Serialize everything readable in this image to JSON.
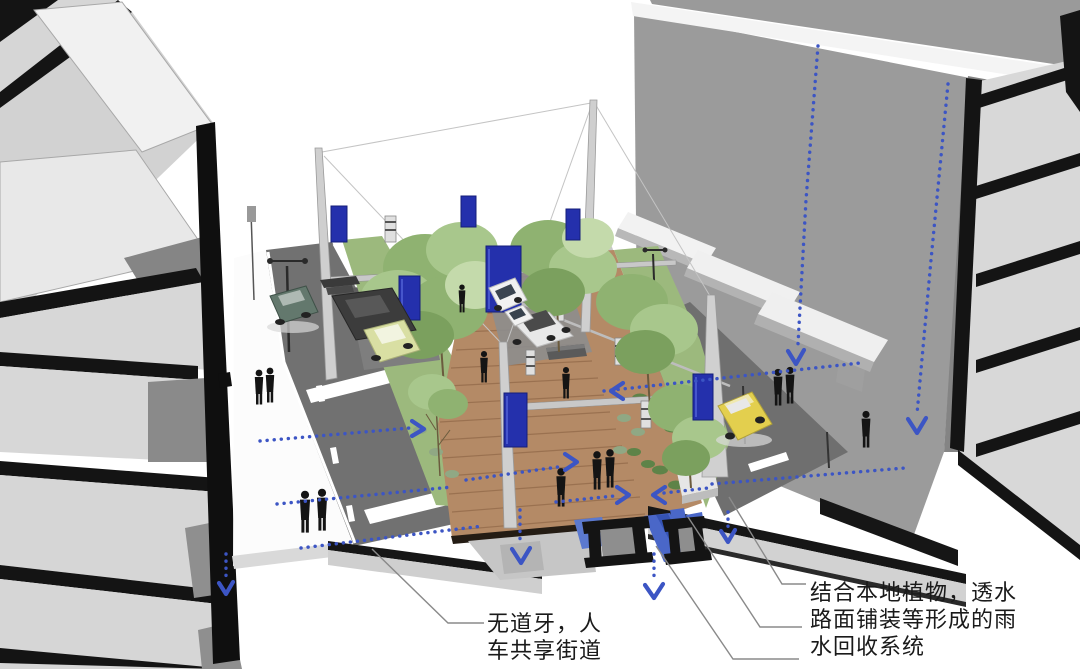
{
  "scene": {
    "type": "axonometric-sectional-street-diagram",
    "background": "#ffffff"
  },
  "annotations": {
    "shared_street": {
      "line1": "无道牙，人",
      "line2": "车共享街道"
    },
    "rainwater_system": {
      "line1": "结合本地植物，透水",
      "line2": "路面铺装等形成的雨",
      "line3": "水回收系统"
    }
  },
  "icons": {
    "flow_arrow": "blue-dotted-arrow",
    "banner": "blue-vertical-banner"
  },
  "colors": {
    "flow_arrows": "#3c55c4",
    "banner_blue": "#2430ac",
    "water": "#4a67c8",
    "deck_wood": "#b48a66",
    "greenery": "#9cb97d",
    "road": "#717171",
    "building_gray": "#9b9b9b",
    "section_black": "#141414",
    "leader_line": "#8a8a8a"
  }
}
